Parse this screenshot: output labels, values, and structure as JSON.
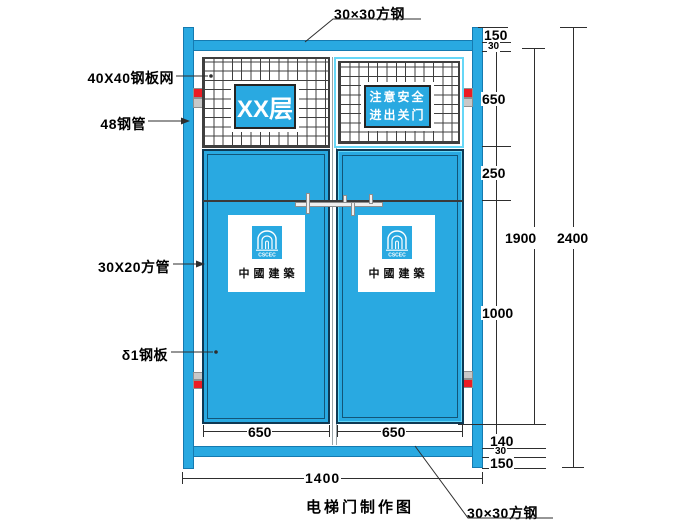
{
  "title": "电梯门制作图",
  "colors": {
    "blue": "#29a9e1",
    "cyan": "#66d7f7",
    "red": "#ec1c24",
    "grayband": "#c8c8c8",
    "line": "#2e2e2e"
  },
  "callouts": {
    "top_square_steel": "30×30方钢",
    "steel_mesh": "40X40钢板网",
    "steel_pipe": "48钢管",
    "square_tube": "30X20方管",
    "steel_plate": "δ1钢板",
    "bottom_square_steel": "30×30方钢"
  },
  "signs": {
    "floor": "XX层",
    "safety_line1": "注意安全",
    "safety_line2": "进出关门",
    "brand": "中國建築",
    "brand_mark": "CSCEC"
  },
  "dims": {
    "top_offset": "150",
    "top_rail": "30",
    "mesh_height": "650",
    "upper_panel": "250",
    "lower_panel": "1000",
    "bottom_gap": "140",
    "bottom_rail": "30",
    "bottom_offset": "150",
    "door_height": "1900",
    "total_height": "2400",
    "left_door_width": "650",
    "right_door_width": "650",
    "total_width": "1400"
  }
}
